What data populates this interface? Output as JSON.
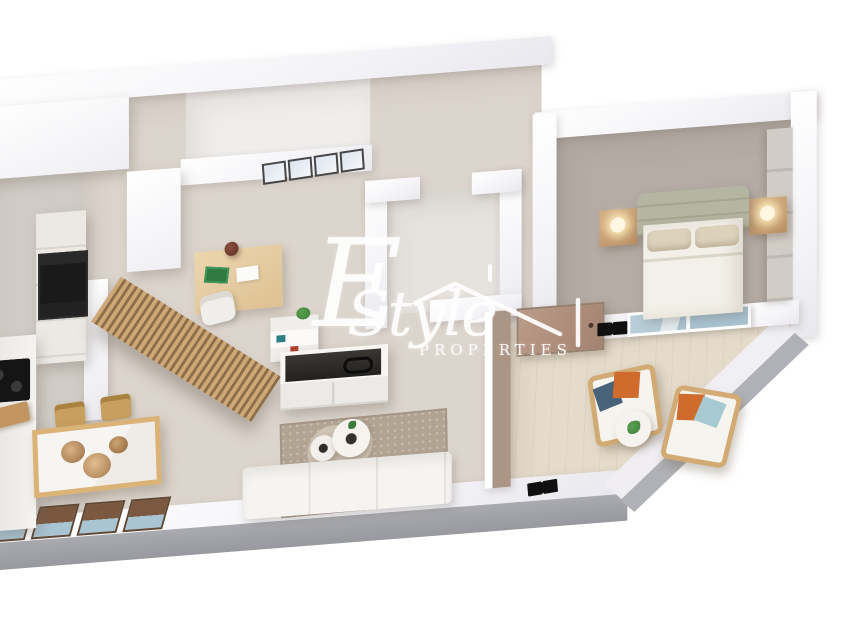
{
  "image": {
    "type": "3d-isometric-floorplan-render",
    "width": 850,
    "height": 620
  },
  "watermark": {
    "initial": "E",
    "wordmark": "Style",
    "subtitle": "PROPERTIES",
    "icon": "house-roof-icon",
    "color": "#ffffff"
  },
  "colors": {
    "background": "#ffffff",
    "wall_white": "#ffffff",
    "wall_shade": "#e9e8ee",
    "floor_main": "#dcd5cd",
    "floor_kitchen": "#d0cbc5",
    "floor_bathroom": "#e6e2de",
    "floor_toproom": "#f0eeec",
    "floor_bedroom": "#b4aca5",
    "floor_terrace": "#e4dbca",
    "rug": "#b3a393",
    "wood": "#c9a06a",
    "slat_light": "#cfa878",
    "slat_dark": "#8f6f4a",
    "marble": "#f5f3f0",
    "tv_dark": "#35322f",
    "appliance_black": "#1b1a1a",
    "headboard_sage": "#b5b6a1",
    "bedding_white": "#f3f0e9",
    "pillow_beige": "#dcd1ba",
    "cushion_orange": "#cf6b2d",
    "cushion_darkblue": "#48627a",
    "cushion_lightblue": "#a7c9d1",
    "glass_blue": "#a9c4d3",
    "window_brown": "#7b5941",
    "window_frame": "#5f4733",
    "door_tan": "#b19180",
    "terrace_wall_taupe": "#ab9584",
    "base_gray": "#a2a3a8",
    "plant_green": "#3f7b3c"
  },
  "scene": {
    "view": "isometric top-down 3d apartment render",
    "rooms": [
      {
        "name": "kitchen",
        "items": [
          "tall-cabinet",
          "cabinet-run",
          "oven",
          "cooktop",
          "counter",
          "island",
          "cutting-board"
        ]
      },
      {
        "name": "dining-area",
        "items": [
          "dining-table",
          "wooden-chairs",
          "serving-bowls"
        ]
      },
      {
        "name": "home-office",
        "items": [
          "desk",
          "desk-lamp",
          "notebook",
          "paper",
          "desk-chair",
          "wood-slat-partition"
        ]
      },
      {
        "name": "living-room",
        "items": [
          "tv-console",
          "tv",
          "shelf-unit",
          "plant",
          "area-rug",
          "round-coffee-tables",
          "sofa"
        ]
      },
      {
        "name": "hallway",
        "items": [
          "picture-frames",
          "closet",
          "entry-door"
        ]
      },
      {
        "name": "bathroom",
        "items": []
      },
      {
        "name": "bedroom",
        "items": [
          "double-bed",
          "sage-headboard",
          "pillows",
          "floating-nightstands",
          "bedside-lamps",
          "wardrobe",
          "sliding-glass-door"
        ]
      },
      {
        "name": "terrace",
        "items": [
          "armchairs",
          "throw-pillows",
          "round-side-table",
          "plant",
          "black-wall-lamps",
          "diagonal-parapet"
        ]
      },
      {
        "name": "facade",
        "items": [
          "windows"
        ]
      }
    ],
    "counts": {
      "picture_frames": 4,
      "facade_windows": 4,
      "dining_chairs": 2,
      "nightstands": 2,
      "terrace_armchairs": 2,
      "coffee_tables": 2,
      "wall_lamps": 2
    }
  }
}
